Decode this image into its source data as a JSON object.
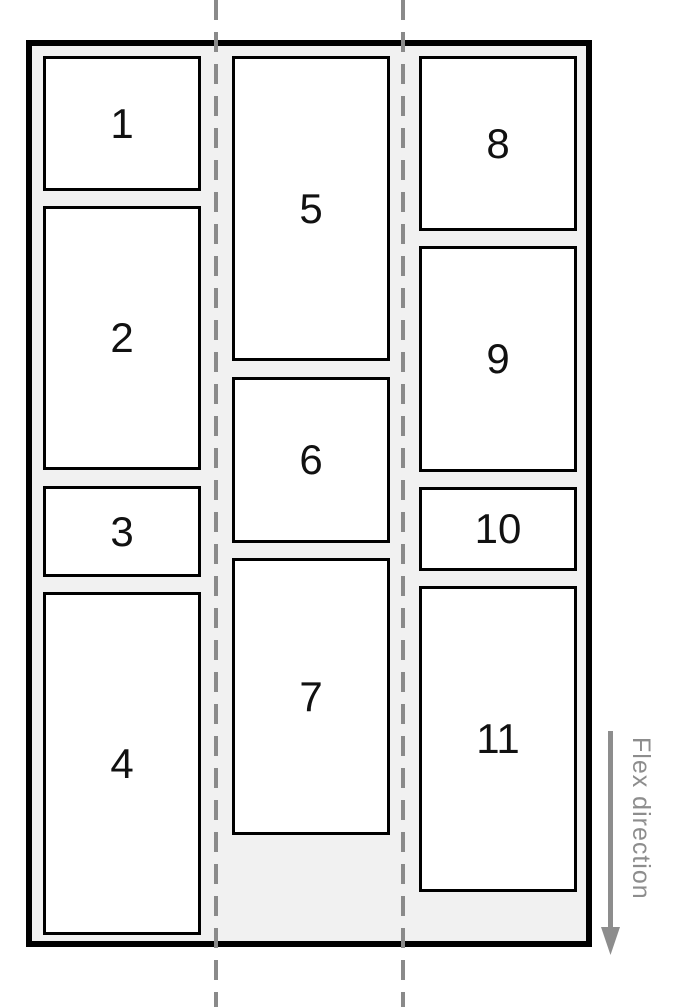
{
  "items": [
    {
      "label": "1"
    },
    {
      "label": "2"
    },
    {
      "label": "3"
    },
    {
      "label": "4"
    },
    {
      "label": "5"
    },
    {
      "label": "6"
    },
    {
      "label": "7"
    },
    {
      "label": "8"
    },
    {
      "label": "9"
    },
    {
      "label": "10"
    },
    {
      "label": "11"
    }
  ],
  "annotation": {
    "label": "Flex direction",
    "arrow_icon": "arrow-down-icon"
  },
  "colors": {
    "container_bg": "#f1f1f1",
    "item_bg": "#ffffff",
    "border": "#000000",
    "guide_line": "#8a8a8a",
    "annotation": "#8d8d8d",
    "item_text": "#111111"
  }
}
